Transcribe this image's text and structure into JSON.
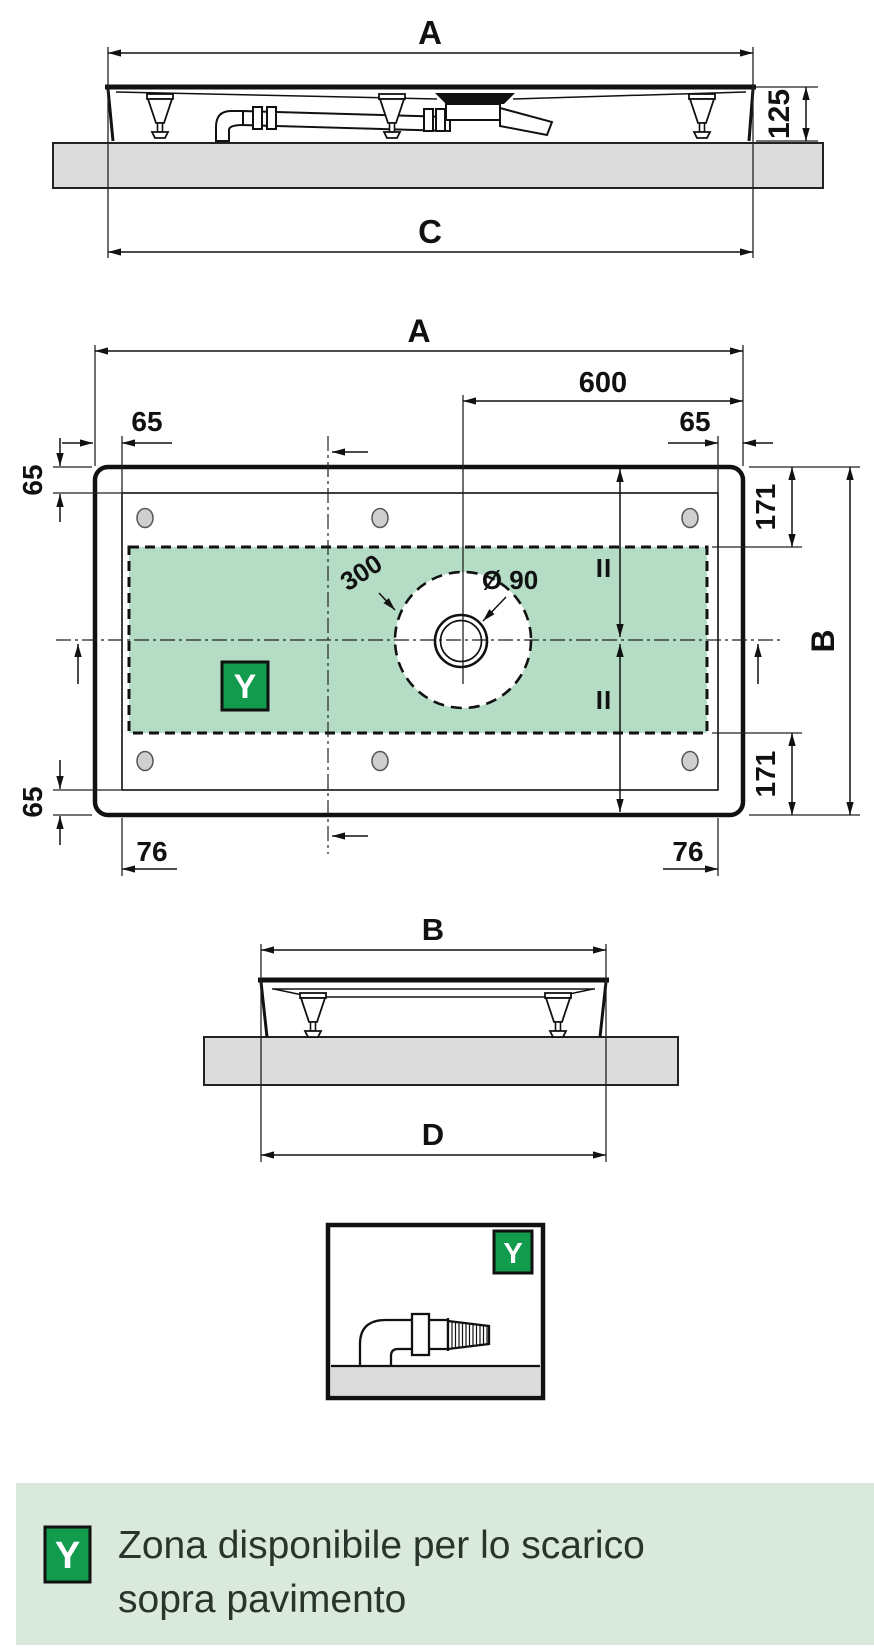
{
  "colors": {
    "badge_green": "#129a4d",
    "zone_green": "#b5dcc5",
    "legend_bg": "#d9e9db",
    "slab_gray": "#dcdcdc",
    "line": "#111111",
    "legend_text": "#28352c"
  },
  "side_view": {
    "dim_width_top": "A",
    "dim_width_bottom": "C",
    "dim_height": "125"
  },
  "plan_view": {
    "dim_width": "A",
    "dim_drain_offset": "600",
    "dim_edge_top_left": "65",
    "dim_edge_top_right": "65",
    "dim_edge_left_upper": "65",
    "dim_edge_left_lower": "65",
    "dim_flange_top": "171",
    "dim_flange_bottom": "171",
    "dim_depth": "B",
    "dim_foot_left": "76",
    "dim_foot_right": "76",
    "dim_drain_zone": "300",
    "dim_drain_diameter": "Ø 90",
    "equal_mark_upper": "II",
    "equal_mark_lower": "II",
    "zone_symbol": "Y"
  },
  "end_view": {
    "dim_width_top": "B",
    "dim_width_bottom": "D"
  },
  "detail_view": {
    "zone_symbol": "Y"
  },
  "legend": {
    "symbol": "Y",
    "text_line1": "Zona disponibile per lo scarico",
    "text_line2": "sopra pavimento"
  }
}
